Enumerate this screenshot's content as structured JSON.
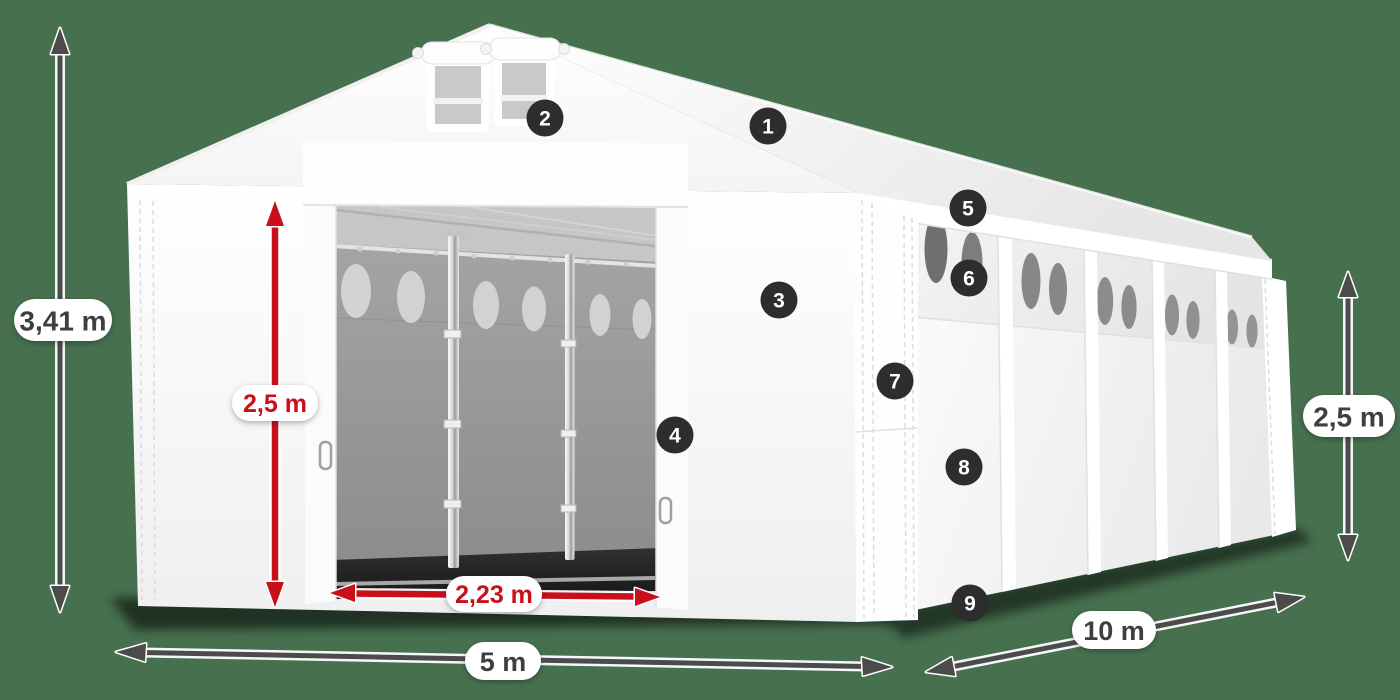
{
  "dimensions": {
    "total_height": "3,41 m",
    "inner_height": "2,5 m",
    "door_width": "2,23 m",
    "width": "5 m",
    "length": "10 m",
    "side_height": "2,5 m"
  },
  "callouts": [
    "1",
    "2",
    "3",
    "4",
    "5",
    "6",
    "7",
    "8",
    "9"
  ],
  "icons": {
    "total_height": "double-arrow-vertical",
    "inner_height": "double-arrow-vertical",
    "door_width": "double-arrow-horizontal",
    "width": "double-arrow-horizontal",
    "length": "double-arrow-diagonal",
    "side_height": "double-arrow-vertical"
  },
  "colors": {
    "background": "#47704F",
    "tent_white": "#FFFFFF",
    "accent_red": "#C9101A",
    "dimension_arrow": "#4B4B4B",
    "badge_background": "#2D2D2D",
    "badge_text": "#FFFFFF",
    "interior_gray": "#9C9C9C",
    "window_gray": "#7D7D7D"
  }
}
